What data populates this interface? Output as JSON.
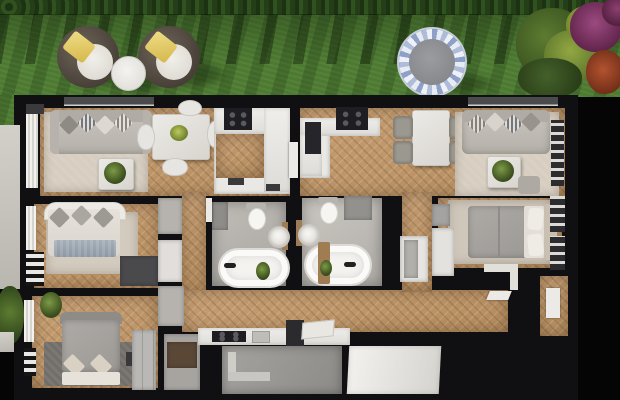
{
  "scene": {
    "type": "3d-floor-plan",
    "view": "top-down-render",
    "garden": {
      "planting": [
        "hedge-row",
        "lawn",
        "flowering-shrubs-green",
        "flowering-shrub-purple",
        "flowering-shrub-red"
      ],
      "furniture": [
        {
          "name": "wicker-lounge-chair",
          "count": 2,
          "cushion": "white",
          "pillow": "yellow"
        },
        {
          "name": "round-side-table",
          "count": 1
        },
        {
          "name": "trampoline",
          "count": 1,
          "ring": "blue-white",
          "mat": "gray"
        }
      ]
    },
    "rooms": [
      {
        "name": "living-room-left",
        "furniture": [
          "sofa",
          "pillows",
          "coffee-table",
          "plant",
          "rug",
          "window-blinds"
        ]
      },
      {
        "name": "dining-area-left",
        "furniture": [
          "square-table",
          "plant-centerpiece",
          "chairs-white"
        ]
      },
      {
        "name": "kitchen-left",
        "furniture": [
          "cooktop",
          "l-shaped-counter",
          "floor-mats"
        ]
      },
      {
        "name": "kitchen-middle",
        "furniture": [
          "cooktop",
          "counter",
          "tall-appliance"
        ]
      },
      {
        "name": "dining-area-middle",
        "furniture": [
          "rect-table",
          "chairs-gray-4"
        ]
      },
      {
        "name": "living-room-right",
        "furniture": [
          "sofa",
          "pillows",
          "coffee-table",
          "plant",
          "rug",
          "ottoman",
          "window-bench"
        ]
      },
      {
        "name": "bedroom-left-upper",
        "furniture": [
          "double-bed",
          "pillows",
          "blue-blanket",
          "striped-wardrobe",
          "dresser",
          "rug"
        ]
      },
      {
        "name": "bedroom-left-lower",
        "furniture": [
          "double-bed-gray",
          "plant",
          "dark-rug",
          "wardrobe-column",
          "nightstand"
        ]
      },
      {
        "name": "closet-room",
        "furniture": [
          "brown-cabinet"
        ]
      },
      {
        "name": "bathroom-left",
        "fixtures": [
          "freestanding-bathtub",
          "toilet",
          "round-washbasin",
          "plant",
          "cabinet"
        ]
      },
      {
        "name": "bathroom-right",
        "fixtures": [
          "freestanding-bathtub",
          "wood-tray",
          "toilet",
          "round-washbasin",
          "shower-cabinet"
        ]
      },
      {
        "name": "bedroom-right",
        "furniture": [
          "double-bed",
          "pillows",
          "shelf-wardrobe",
          "white-closet",
          "rug"
        ]
      },
      {
        "name": "hallway-left",
        "furniture": [
          "built-in-closets"
        ]
      },
      {
        "name": "hallway-middle",
        "furniture": [
          "white-cabinet"
        ]
      },
      {
        "name": "entry-kitchenette",
        "furniture": [
          "counter-with-cooktop",
          "sink",
          "cutting-board",
          "chimney-block"
        ]
      },
      {
        "name": "entrance-area",
        "features": [
          "concrete-landing",
          "steps",
          "white-ramp-panel"
        ]
      }
    ],
    "counts": {
      "bathtubs": 2,
      "toilets": 2,
      "washbasins": 2,
      "beds": 3,
      "sofas": 2,
      "dining_tables": 2,
      "cooktops": 3
    }
  },
  "palette": {
    "bg": "#050505",
    "wall": "#101012",
    "grass": "#4d7a31",
    "wood": "#c59e73",
    "rug": "#d7cec1",
    "tile": "#b5b2ac",
    "counter-white": "#e9e8e4",
    "cooktop-black": "#1e1e22",
    "sofa-gray": "#c0bcb5",
    "bed-gray": "#a5a3a1",
    "blanket-blue": "#9aa4ae",
    "concrete": "#9b9995",
    "pavement": "#c8c5bf",
    "pillow-yellow": "#e5cd68",
    "trampoline-blue": "#8fa0c8",
    "bush-purple": "#8e3f72",
    "bush-red": "#aa4a2c",
    "plant-green": "#5d7a33"
  }
}
